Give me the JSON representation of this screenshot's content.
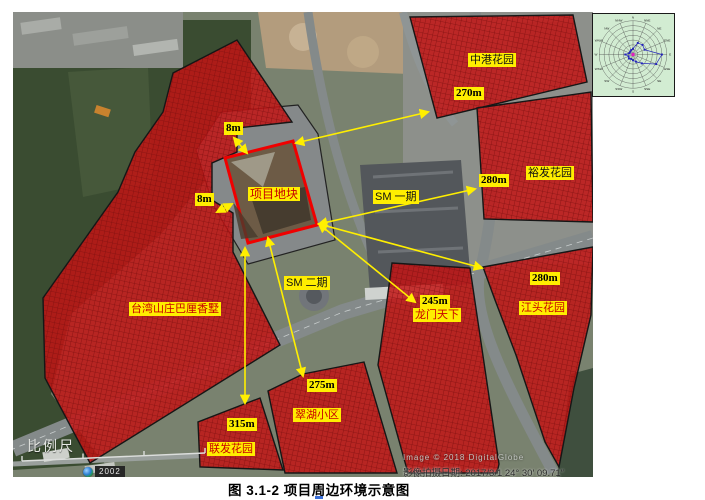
{
  "figure": {
    "caption": "图 3.1-2  项目周边环境示意图"
  },
  "map": {
    "site_label": "项目地块",
    "phase_labels": {
      "sm1": "SM 一期",
      "sm2": "SM 二期"
    },
    "gap_labels": {
      "north": "8m",
      "west": "8m"
    },
    "areas": [
      {
        "name": "台湾山庄巴厘香墅",
        "distance": ""
      },
      {
        "name": "中港花园",
        "distance": "270m"
      },
      {
        "name": "裕发花园",
        "distance": "280m"
      },
      {
        "name": "江头花园",
        "distance": "280m"
      },
      {
        "name": "龙门天下",
        "distance": "245m"
      },
      {
        "name": "翠湖小区",
        "distance": "275m"
      },
      {
        "name": "联发花园",
        "distance": "315m"
      }
    ],
    "scale_label": "比例尺",
    "badge_year": "2002",
    "watermark_line1": "Image © 2018 DigitalGlobe",
    "watermark_line2": "影像拍摄日期: 2017/3/1    24° 30′ 09.71″",
    "colors": {
      "residential_fill": "#c31313",
      "site_border": "#ff0000",
      "arrow": "#ffef00",
      "label_bg": "#ffee00",
      "label_text_red": "#c80000",
      "label_text_black": "#111111"
    }
  },
  "wind_rose": {
    "directions": [
      "N",
      "NNE",
      "NE",
      "ENE",
      "E",
      "ESE",
      "SE",
      "SSE",
      "S",
      "SSW",
      "SW",
      "WSW",
      "W",
      "WNW",
      "NW",
      "NNW"
    ],
    "values": [
      6,
      13,
      14,
      13,
      30,
      26,
      13,
      8,
      6,
      5,
      6,
      5,
      8,
      4,
      4,
      5
    ]
  }
}
